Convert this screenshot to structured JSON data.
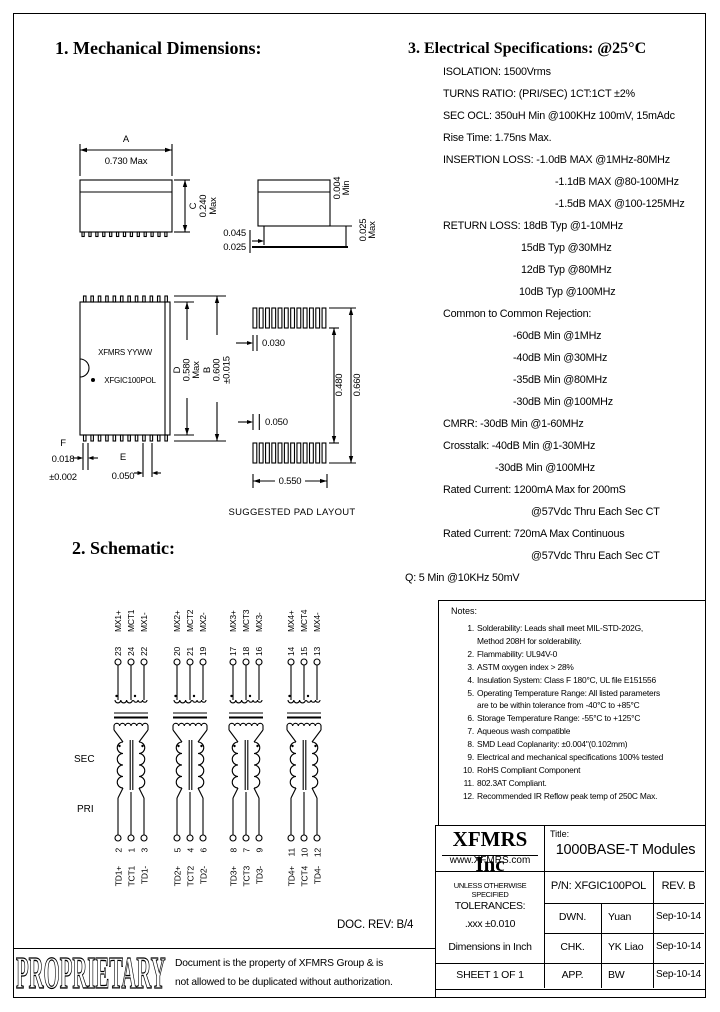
{
  "headings": {
    "mechanical": "1. Mechanical Dimensions:",
    "schematic": "2. Schematic:",
    "electrical": "3. Electrical Specifications: @25°C"
  },
  "mech": {
    "a_letter": "A",
    "a_val": "0.730 Max",
    "c_letter": "C",
    "c_val": "0.240",
    "c_unit": "Max",
    "sv_gap": "0.004",
    "sv_gap_u": "Min",
    "sv_lead": "0.025",
    "sv_lead_u": "Max",
    "sv_w1": "0.045",
    "sv_w2": "0.025",
    "d_letter": "D",
    "d_val": "0.580",
    "d_unit": "Max",
    "b_letter": "B",
    "b_val": "0.600",
    "b_tol": "±0.015",
    "f_letter": "F",
    "f_val": "0.018",
    "f_tol": "±0.002",
    "e_letter": "E",
    "e_val": "0.050",
    "pad_w": "0.030",
    "pad_pitch": "0.050",
    "pad_in": "0.480",
    "pad_out": "0.660",
    "pad_span": "0.550",
    "label_line1": "XFMRS YYWW",
    "label_line2": "XFGIC100POL",
    "pad_caption": "SUGGESTED PAD LAYOUT"
  },
  "specs": {
    "lines": [
      {
        "text": "ISOLATION: 1500Vrms",
        "indent": 0
      },
      {
        "text": "TURNS RATIO: (PRI/SEC) 1CT:1CT ±2%",
        "indent": 0
      },
      {
        "text": "SEC OCL: 350uH Min @100KHz 100mV, 15mAdc",
        "indent": 0
      },
      {
        "text": "Rise Time: 1.75ns Max.",
        "indent": 0
      },
      {
        "text": "INSERTION LOSS: -1.0dB MAX @1MHz-80MHz",
        "indent": 0
      },
      {
        "text": "-1.1dB MAX @80-100MHz",
        "indent": 112
      },
      {
        "text": "-1.5dB MAX @100-125MHz",
        "indent": 112
      },
      {
        "text": "RETURN LOSS: 18dB Typ @1-10MHz",
        "indent": 0
      },
      {
        "text": "15dB Typ @30MHz",
        "indent": 78
      },
      {
        "text": "12dB Typ @80MHz",
        "indent": 78
      },
      {
        "text": "10dB Typ @100MHz",
        "indent": 76
      },
      {
        "text": "Common to Common Rejection:",
        "indent": 0
      },
      {
        "text": "-60dB Min @1MHz",
        "indent": 70
      },
      {
        "text": "-40dB Min @30MHz",
        "indent": 70
      },
      {
        "text": "-35dB Min @80MHz",
        "indent": 70
      },
      {
        "text": "-30dB Min @100MHz",
        "indent": 70
      },
      {
        "text": "CMRR: -30dB Min @1-60MHz",
        "indent": 0
      },
      {
        "text": "Crosstalk: -40dB Min @1-30MHz",
        "indent": 0
      },
      {
        "text": "-30dB Min @100MHz",
        "indent": 52
      },
      {
        "text": "Rated Current: 1200mA Max for 200mS",
        "indent": 0
      },
      {
        "text": "@57Vdc Thru Each Sec CT",
        "indent": 88
      },
      {
        "text": "Rated Current:  720mA Max Continuous",
        "indent": 0
      },
      {
        "text": "@57Vdc Thru Each Sec CT",
        "indent": 88
      },
      {
        "text": "Q: 5 Min @10KHz 50mV",
        "indent": -38
      }
    ]
  },
  "notes": {
    "title": "Notes:",
    "items": [
      {
        "num": "1.",
        "lines": [
          "Solderability: Leads shall meet MIL-STD-202G,",
          "Method 208H for solderability."
        ]
      },
      {
        "num": "2.",
        "lines": [
          "Flammability: UL94V-0"
        ]
      },
      {
        "num": "3.",
        "lines": [
          "ASTM oxygen index > 28%"
        ]
      },
      {
        "num": "4.",
        "lines": [
          "Insulation System: Class F 180°C, UL file E151556"
        ]
      },
      {
        "num": "5.",
        "lines": [
          "Operating Temperature Range: All listed parameters",
          "are to be within tolerance from -40°C to +85°C"
        ]
      },
      {
        "num": "6.",
        "lines": [
          "Storage Temperature Range: -55°C to +125°C"
        ]
      },
      {
        "num": "7.",
        "lines": [
          "Aqueous wash compatible"
        ]
      },
      {
        "num": "8.",
        "lines": [
          "SMD Lead Coplanarity: ±0.004\"(0.102mm)"
        ]
      },
      {
        "num": "9.",
        "lines": [
          "Electrical and mechanical specifications 100% tested"
        ]
      },
      {
        "num": "10.",
        "lines": [
          "RoHS Compliant Component"
        ]
      },
      {
        "num": "11.",
        "lines": [
          "802.3AT Compliant."
        ]
      },
      {
        "num": "12.",
        "lines": [
          "Recommended IR Reflow peak temp of 250C Max."
        ]
      }
    ]
  },
  "schematic": {
    "sec_label": "SEC",
    "pri_label": "PRI",
    "channels": [
      {
        "top": [
          {
            "label": "MX1+",
            "pin": "23"
          },
          {
            "label": "MCT1",
            "pin": "24"
          },
          {
            "label": "MX1-",
            "pin": "22"
          }
        ],
        "bottom": [
          {
            "label": "TD1+",
            "pin": "2"
          },
          {
            "label": "TCT1",
            "pin": "1"
          },
          {
            "label": "TD1-",
            "pin": "3"
          }
        ]
      },
      {
        "top": [
          {
            "label": "MX2+",
            "pin": "20"
          },
          {
            "label": "MCT2",
            "pin": "21"
          },
          {
            "label": "MX2-",
            "pin": "19"
          }
        ],
        "bottom": [
          {
            "label": "TD2+",
            "pin": "5"
          },
          {
            "label": "TCT2",
            "pin": "4"
          },
          {
            "label": "TD2-",
            "pin": "6"
          }
        ]
      },
      {
        "top": [
          {
            "label": "MX3+",
            "pin": "17"
          },
          {
            "label": "MCT3",
            "pin": "18"
          },
          {
            "label": "MX3-",
            "pin": "16"
          }
        ],
        "bottom": [
          {
            "label": "TD3+",
            "pin": "8"
          },
          {
            "label": "TCT3",
            "pin": "7"
          },
          {
            "label": "TD3-",
            "pin": "9"
          }
        ]
      },
      {
        "top": [
          {
            "label": "MX4+",
            "pin": "14"
          },
          {
            "label": "MCT4",
            "pin": "15"
          },
          {
            "label": "MX4-",
            "pin": "13"
          }
        ],
        "bottom": [
          {
            "label": "TD4+",
            "pin": "11"
          },
          {
            "label": "TCT4",
            "pin": "10"
          },
          {
            "label": "TD4-",
            "pin": "12"
          }
        ]
      }
    ]
  },
  "doc_rev": "DOC. REV: B/4",
  "proprietary": {
    "word": "PROPRIETARY",
    "line1": "Document is the property of XFMRS Group & is",
    "line2": "not allowed to be duplicated without authorization."
  },
  "titleblock": {
    "company": "XFMRS Inc",
    "website": "www.XFMRS.com",
    "title_label": "Title:",
    "title": "1000BASE-T Modules",
    "tol1": "UNLESS OTHERWISE SPECIFIED",
    "tol2": "TOLERANCES:",
    "tol3": ".xxx ±0.010",
    "tol4": "Dimensions in Inch",
    "sheet": "SHEET 1 OF 1",
    "pn": "P/N: XFGIC100POL",
    "rev": "REV. B",
    "rows": [
      {
        "label": "DWN.",
        "value": "Yuan",
        "date": "Sep-10-14"
      },
      {
        "label": "CHK.",
        "value": "YK Liao",
        "date": "Sep-10-14"
      },
      {
        "label": "APP.",
        "value": "BW",
        "date": "Sep-10-14"
      }
    ]
  }
}
